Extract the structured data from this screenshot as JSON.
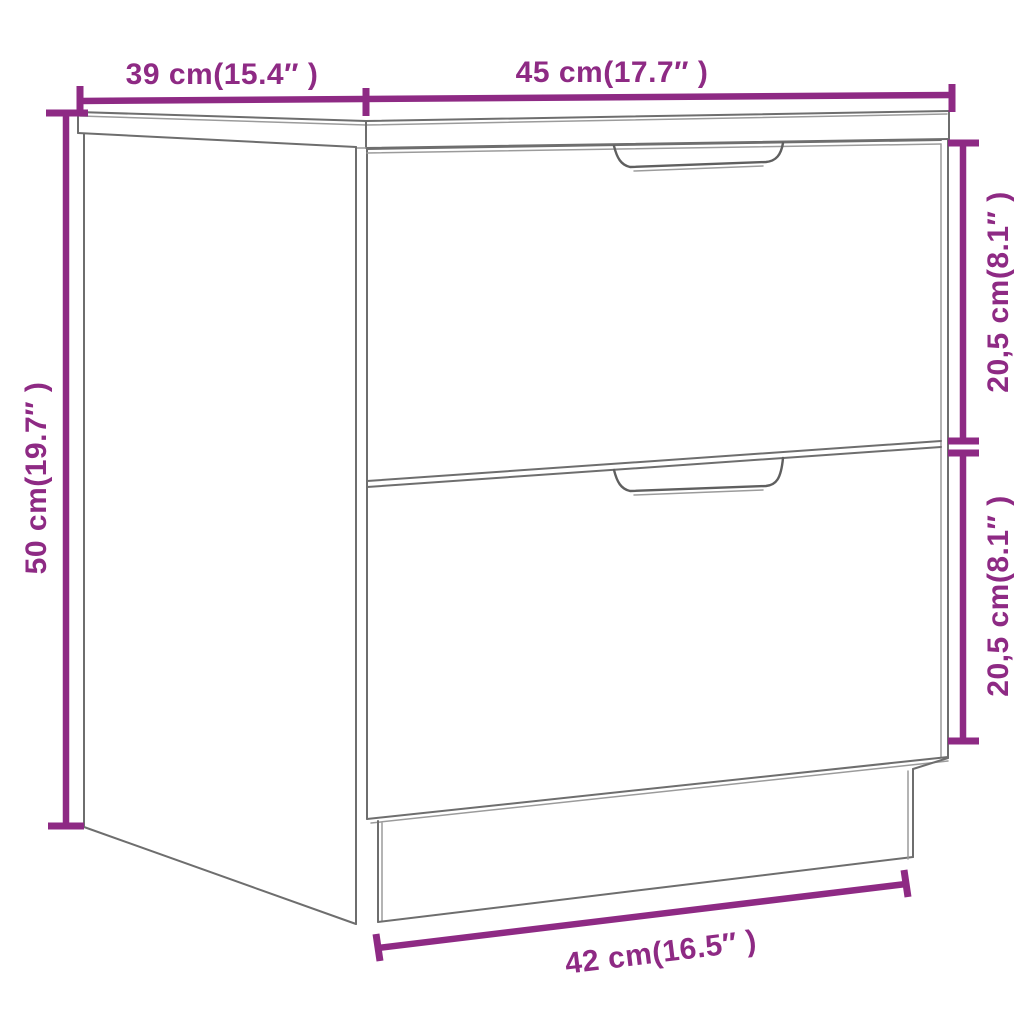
{
  "diagram": {
    "title": "nightstand-two-drawers-dimension-diagram",
    "colors": {
      "accent": "#8e2a84",
      "outline": "#6e6e6e",
      "outline_light": "#9b9b9b",
      "background": "#ffffff"
    },
    "dimensions": {
      "top_left": {
        "label": "39 cm(15.4″ )"
      },
      "top_right": {
        "label": "45 cm(17.7″ )"
      },
      "left": {
        "label": "50 cm(19.7″ )"
      },
      "right_top": {
        "label": "20,5 cm(8.1″ )"
      },
      "right_bottom": {
        "label": "20,5 cm(8.1″ )"
      },
      "bottom": {
        "label": "42 cm(16.5″ )"
      }
    }
  }
}
